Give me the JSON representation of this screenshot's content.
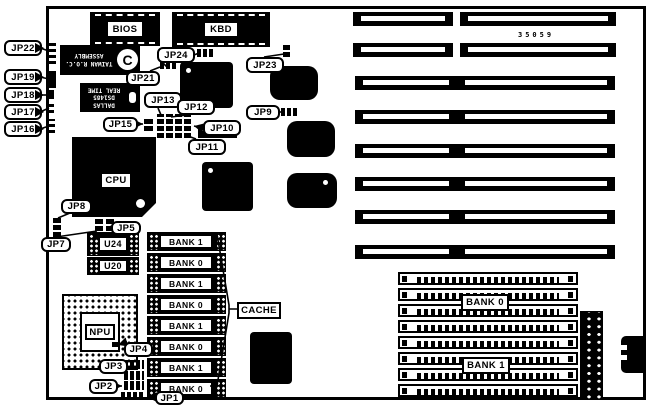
{
  "figure": {
    "part_number": "35059"
  },
  "chips": {
    "bios": {
      "label": "BIOS"
    },
    "kbd": {
      "label": "KBD"
    },
    "cpu": {
      "label": "CPU"
    },
    "npu": {
      "label": "NPU"
    },
    "u24": {
      "label": "U24"
    },
    "u20": {
      "label": "U20"
    },
    "chipset": {
      "line1": "TAIWAN R.O.C.",
      "line2": "ASSEMBLY",
      "logo": "C"
    },
    "rtc": {
      "line1": "DALLAS",
      "line2": "DS1485",
      "line3": "REAL TIME"
    }
  },
  "cache": {
    "label": "CACHE",
    "banks": [
      "BANK 1",
      "BANK 0",
      "BANK 1",
      "BANK 0",
      "BANK 1",
      "BANK 0",
      "BANK 1",
      "BANK 0"
    ]
  },
  "simm": {
    "bank_top": "BANK 0",
    "bank_bottom": "BANK 1",
    "rows": 8
  },
  "isa": {
    "rows": 8
  },
  "callouts": [
    {
      "id": "jp22",
      "label": "JP22"
    },
    {
      "id": "jp19",
      "label": "JP19"
    },
    {
      "id": "jp18",
      "label": "JP18"
    },
    {
      "id": "jp17",
      "label": "JP17"
    },
    {
      "id": "jp16",
      "label": "JP16"
    },
    {
      "id": "jp24",
      "label": "JP24"
    },
    {
      "id": "jp21",
      "label": "JP21"
    },
    {
      "id": "jp23",
      "label": "JP23"
    },
    {
      "id": "jp13",
      "label": "JP13"
    },
    {
      "id": "jp12",
      "label": "JP12"
    },
    {
      "id": "jp15",
      "label": "JP15"
    },
    {
      "id": "jp10",
      "label": "JP10"
    },
    {
      "id": "jp9",
      "label": "JP9"
    },
    {
      "id": "jp11",
      "label": "JP11"
    },
    {
      "id": "jp8",
      "label": "JP8"
    },
    {
      "id": "jp7",
      "label": "JP7"
    },
    {
      "id": "jp5",
      "label": "JP5"
    },
    {
      "id": "jp4",
      "label": "JP4"
    },
    {
      "id": "jp3",
      "label": "JP3"
    },
    {
      "id": "jp2",
      "label": "JP2"
    },
    {
      "id": "jp1",
      "label": "JP1"
    }
  ],
  "colors": {
    "ink": "#000000",
    "paper": "#ffffff"
  }
}
